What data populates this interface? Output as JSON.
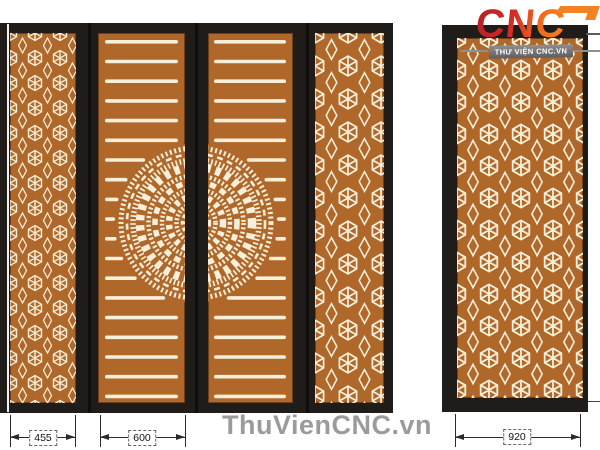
{
  "logo": {
    "brand": "CNC",
    "tagline": "THƯ VIỆN CNC.VN"
  },
  "watermark": "ThuVienCNC.vn",
  "dims": {
    "left_pattern_panel": "455",
    "door_leaf": "600",
    "side_panel": "920"
  },
  "colors": {
    "panel_brown": "#b0682a",
    "cut_cream": "#f6efda",
    "frame_black": "#1f1c19",
    "logo_red": "#b72025",
    "logo_orange": "#f58220",
    "banner_gray": "#5e5e5e",
    "watermark_gray": "#9b9b9b",
    "dimension_ink": "#2a2a2a"
  }
}
